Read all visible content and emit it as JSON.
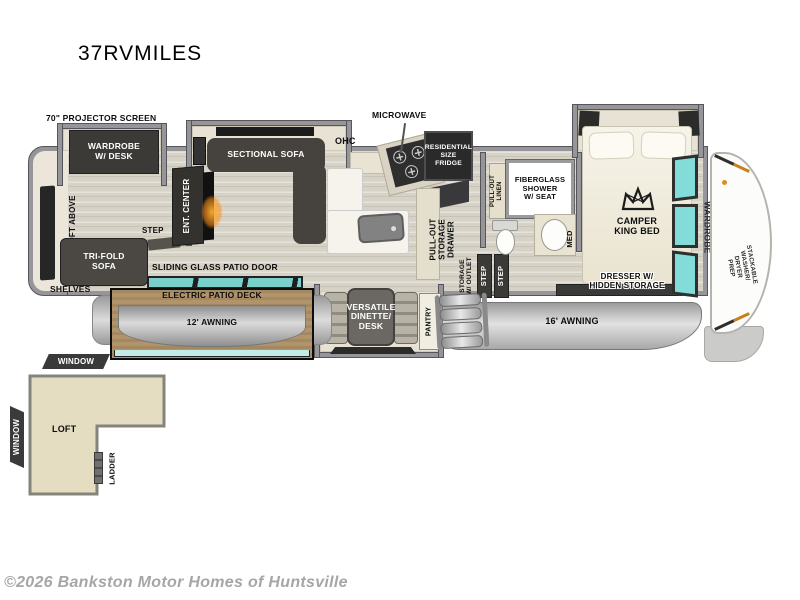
{
  "title": "37RVMILES",
  "watermark": "©2026 Bankston Motor Homes of Huntsville",
  "rear": {
    "projector_screen": "70\" PROJECTOR SCREEN",
    "wardrobe_desk": "WARDROBE\nW/ DESK",
    "loft_above": "LOFT ABOVE",
    "step": "STEP",
    "tri_fold_sofa": "TRI-FOLD\nSOFA",
    "shelves": "SHELVES"
  },
  "living": {
    "ent_center": "ENT. CENTER",
    "sectional_sofa": "SECTIONAL SOFA",
    "sliding_glass_door": "SLIDING GLASS PATIO DOOR",
    "electric_patio_deck": "ELECTRIC PATIO DECK",
    "awning_12": "12' AWNING"
  },
  "kitchen": {
    "ohc": "OHC",
    "microwave": "MICROWAVE",
    "fridge": "RESIDENTIAL\nSIZE\nFRIDGE",
    "pull_out_storage_drawer": "PULL-OUT\nSTORAGE\nDRAWER",
    "dinette": "VERSATILE\nDINETTE/\nDESK",
    "pantry": "PANTRY"
  },
  "entry": {
    "storage_w_outlet": "STORAGE\nW/ OUTLET",
    "step_a": "STEP",
    "step_b": "STEP",
    "awning_16": "16' AWNING"
  },
  "bath": {
    "pull_out_linen": "PULL-OUT\nLINEN",
    "shower": "FIBERGLASS\nSHOWER\nW/ SEAT",
    "med": "MED"
  },
  "bedroom": {
    "camper_king_bed": "CAMPER\nKING BED",
    "dresser": "DRESSER W/\nHIDDEN STORAGE",
    "wardrobe": "WARDROBE",
    "washer_prep": "STACKABLE\nWASHER/\nDRYER\nPREP"
  },
  "loft": {
    "window_top": "WINDOW",
    "window_side": "WINDOW",
    "loft": "LOFT",
    "ladder": "LADDER"
  },
  "colors": {
    "wall_gray": "#95959a",
    "floor_wood": "#d7d2c6",
    "slide_floor": "#e7e2d4",
    "dark_furniture": "#3b3a37",
    "teal_glass": "#7fd6d0",
    "deck_tan": "#b2946a",
    "awning_gray": "#c0c0c0",
    "fireplace_orange": "#f6a62e",
    "accent_orange": "#c8801f",
    "loft_fill": "#e4ddc1",
    "watermark_gray": "#a6a6a6"
  }
}
